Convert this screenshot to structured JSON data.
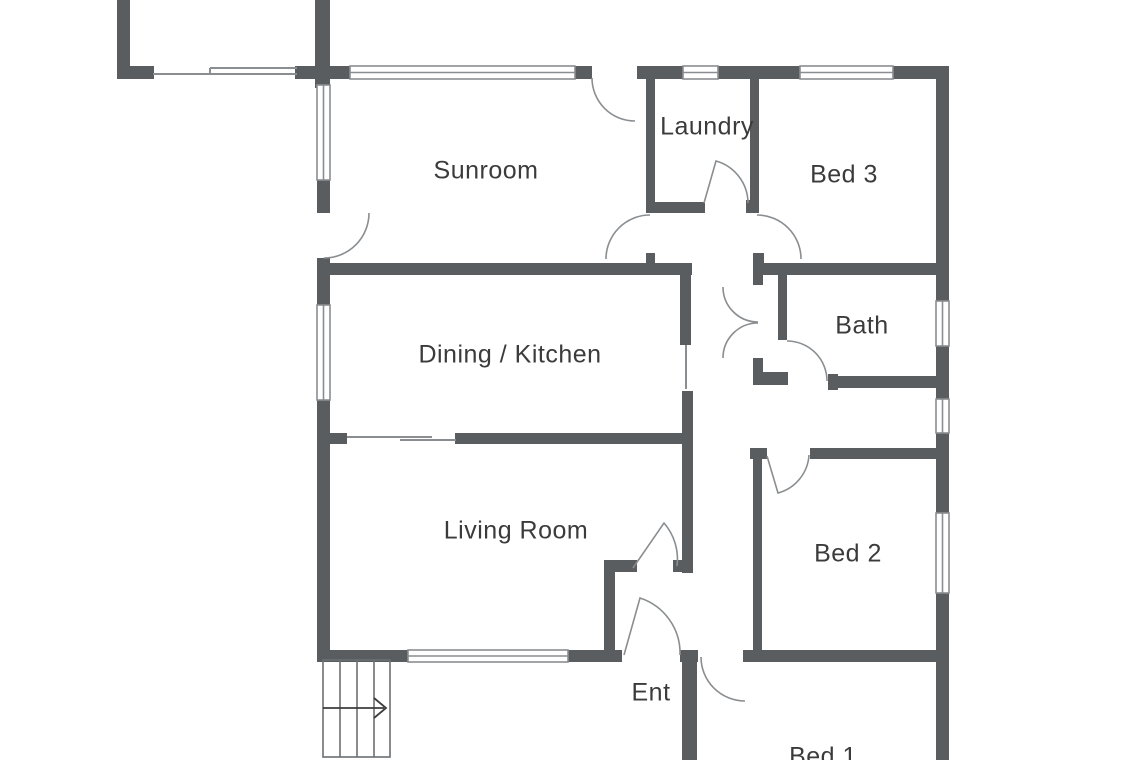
{
  "floorplan": {
    "rooms": {
      "sunroom": {
        "label": "Sunroom"
      },
      "laundry": {
        "label": "Laundry"
      },
      "bed3": {
        "label": "Bed 3"
      },
      "dining_kitchen": {
        "label": "Dining / Kitchen"
      },
      "bath": {
        "label": "Bath"
      },
      "living_room": {
        "label": "Living Room"
      },
      "bed2": {
        "label": "Bed 2"
      },
      "entry": {
        "label": "Ent"
      },
      "bed1": {
        "label": "Bed 1"
      }
    },
    "stairs": {
      "arrow_direction": "right"
    },
    "colors": {
      "wall": "#595d60",
      "line": "#8a8e91",
      "text": "#3b3b3b",
      "background": "#ffffff"
    }
  }
}
